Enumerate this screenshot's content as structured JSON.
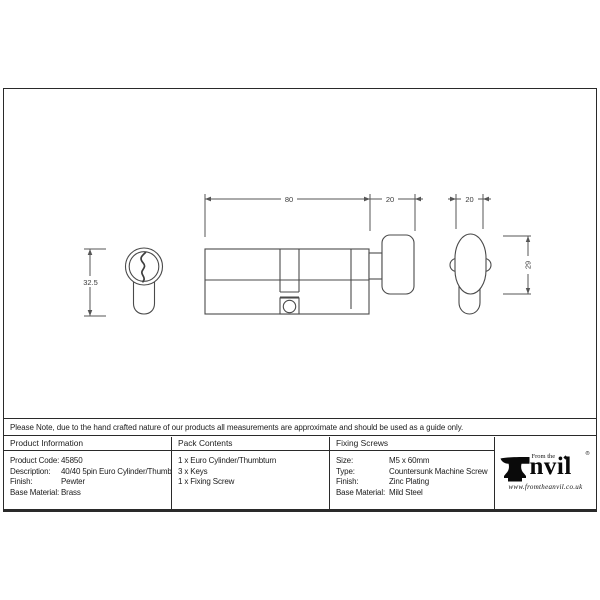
{
  "drawing": {
    "dim_total_length": "80",
    "dim_thumbturn_depth": "20",
    "dim_knob_width": "20",
    "dim_profile_height": "32.5",
    "dim_knob_height": "29"
  },
  "note": "Please Note, due to the hand crafted nature of our products all measurements are approximate and should be used as a guide only.",
  "table": {
    "product_information": {
      "header": "Product Information",
      "rows": [
        {
          "label": "Product Code:",
          "value": "45850"
        },
        {
          "label": "Description:",
          "value": "40/40 5pin Euro Cylinder/Thumbturn"
        },
        {
          "label": "Finish:",
          "value": "Pewter"
        },
        {
          "label": "Base Material:",
          "value": "Brass"
        }
      ]
    },
    "pack_contents": {
      "header": "Pack Contents",
      "items": [
        "1 x Euro Cylinder/Thumbturn",
        "3 x Keys",
        "1 x Fixing Screw"
      ]
    },
    "fixing_screws": {
      "header": "Fixing Screws",
      "rows": [
        {
          "label": "Size:",
          "value": "M5 x 60mm"
        },
        {
          "label": "Type:",
          "value": "Countersunk Machine Screw"
        },
        {
          "label": "Finish:",
          "value": "Zinc Plating"
        },
        {
          "label": "Base Material:",
          "value": "Mild Steel"
        }
      ]
    }
  },
  "logo": {
    "tagline": "From the",
    "brand_suffix": "nvil",
    "registered": "®",
    "website": "www.fromtheanvil.co.uk"
  }
}
